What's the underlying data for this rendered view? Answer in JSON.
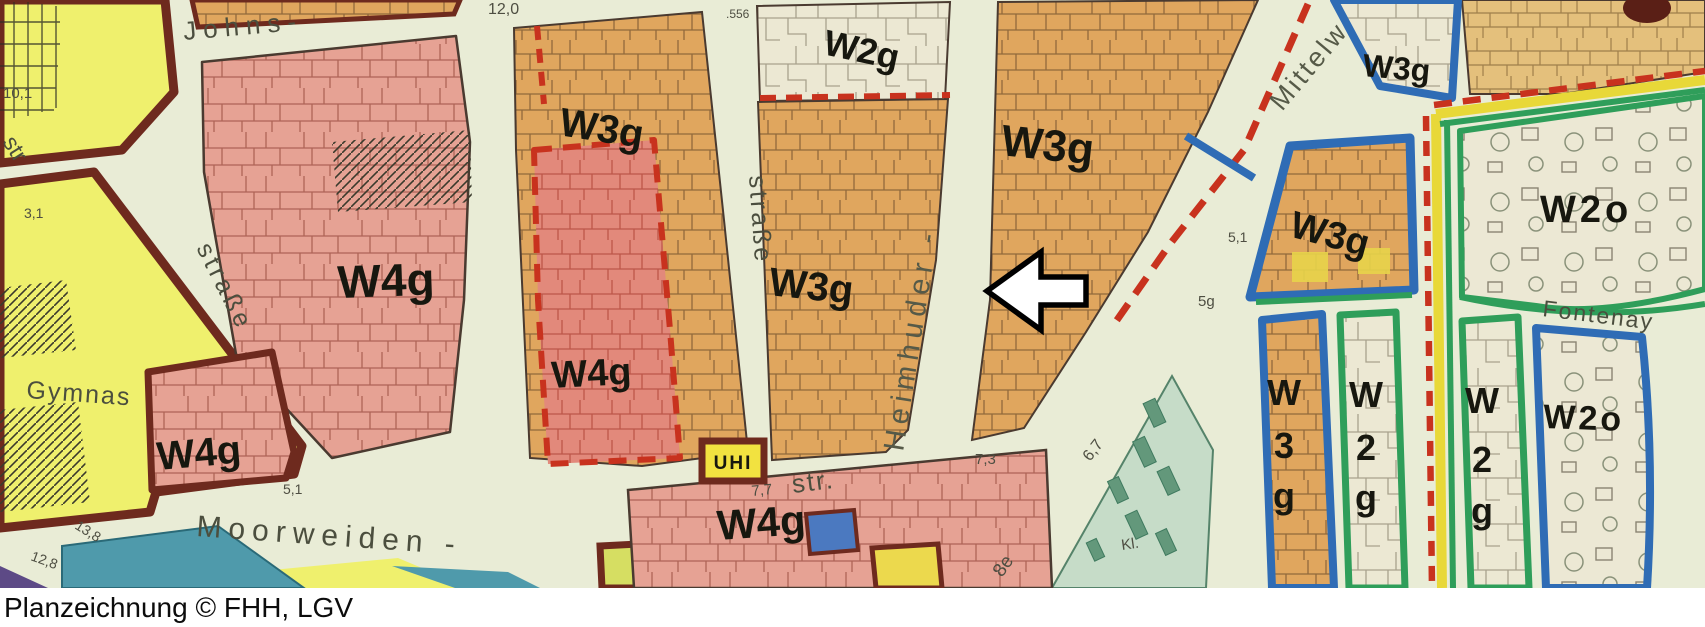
{
  "caption": "Planzeichnung © FHH, LGV",
  "streets": {
    "johns": "Johns-",
    "strasse_left": "straße",
    "strasse_mid": "straße",
    "str_left_edge": "str",
    "gymnas": "Gymnas",
    "heimhuder": "Heimhuder -",
    "mittelweg": "Mittelw",
    "moorweiden": "Moorweiden -",
    "str_abbr": "str.",
    "fontenay": "Fontenay",
    "kl": "Kl."
  },
  "zones": {
    "w4g_main": "W4g",
    "w4g_left": "W4g",
    "w4g_strip": "W4g",
    "w4g_bottom": "W4g",
    "w3g_left": "W3g",
    "w3g_center": "W3g",
    "w3g_right": "W3g",
    "w3g_topright": "W3g",
    "w3g_box": "W3g",
    "w2g_top": "W2g",
    "w2o_top": "W2o",
    "w2o_bottom": "W2o",
    "strip_w3g": [
      "W",
      "3",
      "g"
    ],
    "strip_w2g_a": [
      "W",
      "2",
      "g"
    ],
    "strip_w2g_b": [
      "W",
      "2",
      "g"
    ],
    "vhi_box": "UHI"
  },
  "measurements": [
    "12,0",
    ".556",
    "10,1",
    "3,1",
    "7,7",
    "7,3",
    "6,7",
    "8e",
    "5,1",
    "5g",
    "5,1",
    "13,8",
    "12,8"
  ],
  "colors": {
    "street_background": "#e9ecd6",
    "residential_orange": "#e0a65e",
    "residential_pink": "#e6a294",
    "red_overlay_strip": "#e2897b",
    "public_yellow": "#eff06d",
    "cream_block": "#ece8d3",
    "park_teal": "#4f9aab",
    "park_pale_green": "#c6dcc8",
    "purple_corner": "#5d4a86",
    "border_maroon": "#6e2a1e",
    "boundary_blue": "#2f6cb5",
    "boundary_green": "#2f9e5a",
    "boundary_red_dashed": "#c8321e",
    "boundary_yellow": "#e8d838",
    "arrow_fill": "#ffffff",
    "arrow_outline": "#000000"
  }
}
